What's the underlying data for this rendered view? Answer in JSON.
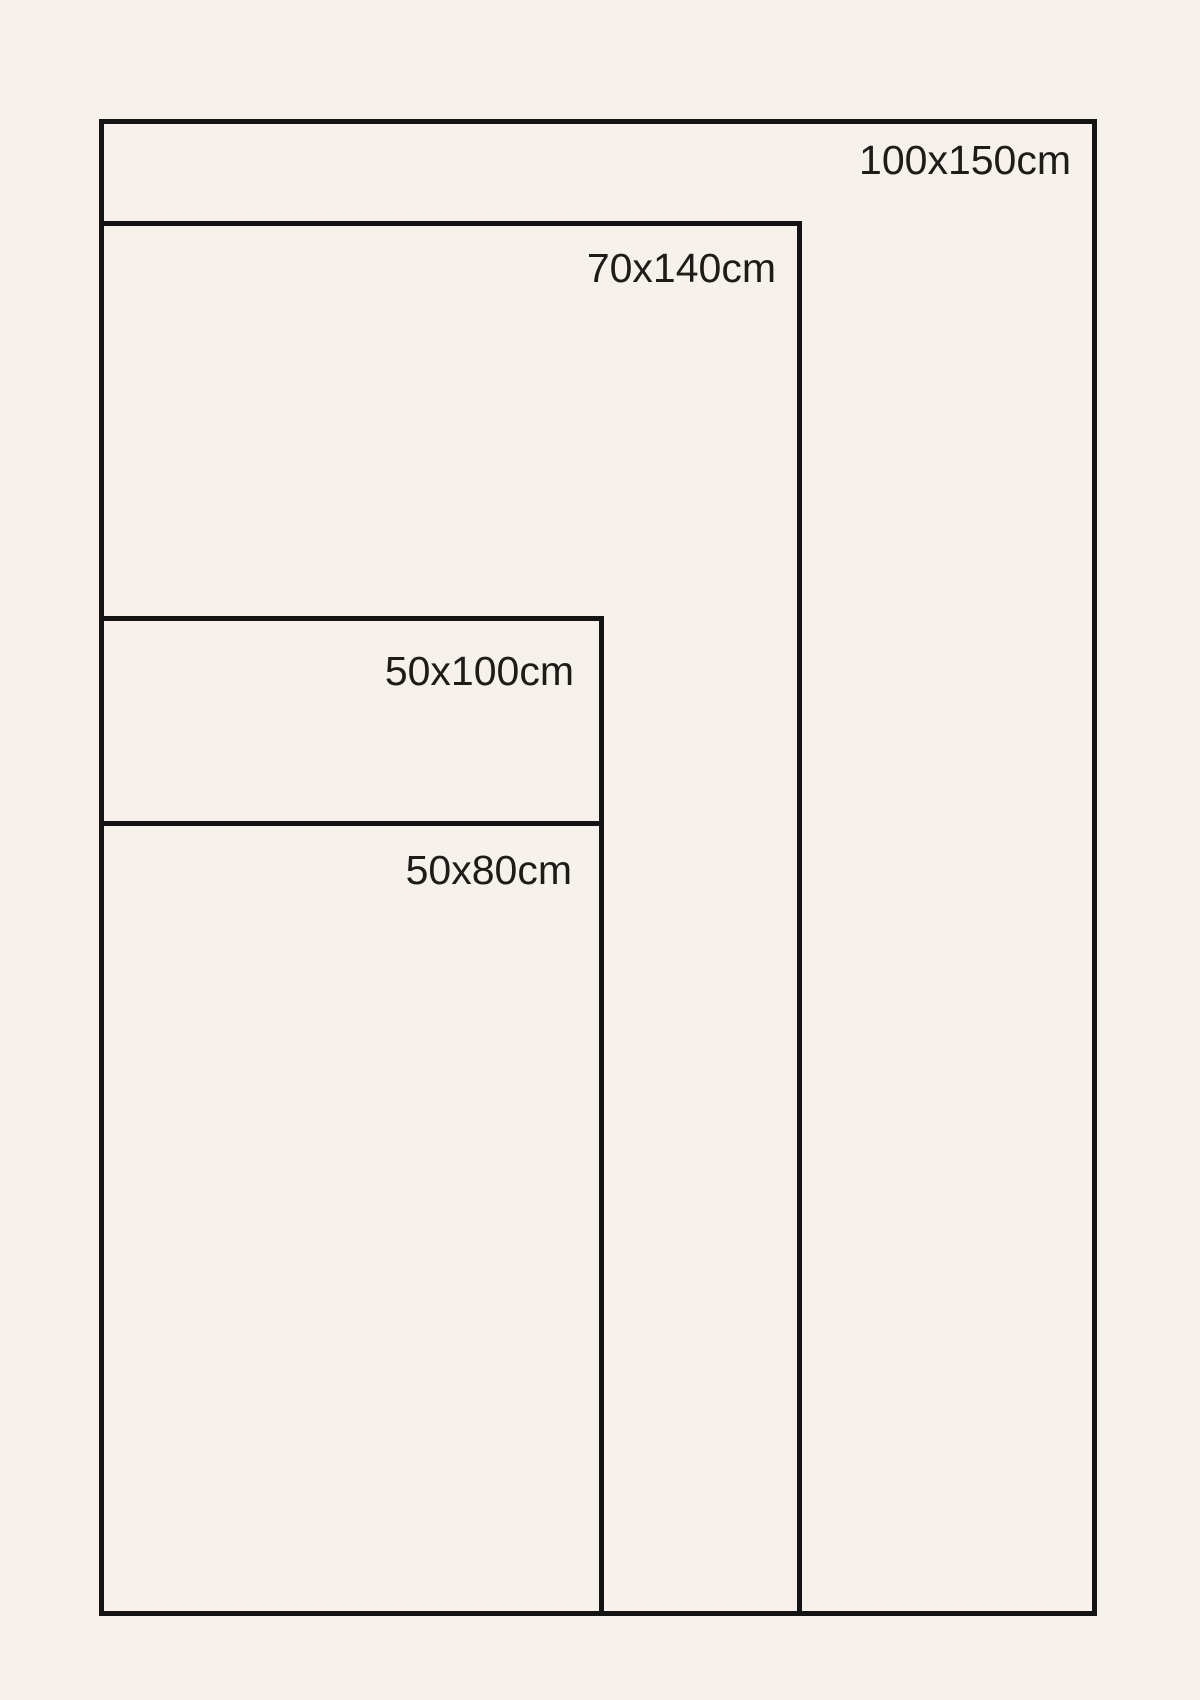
{
  "diagram": {
    "kind": "poster-size-comparison",
    "sizes": [
      {
        "label": "100x150cm",
        "width_cm": 100,
        "height_cm": 150
      },
      {
        "label": "70x140cm",
        "width_cm": 70,
        "height_cm": 140
      },
      {
        "label": "50x100cm",
        "width_cm": 50,
        "height_cm": 100
      },
      {
        "label": "50x80cm",
        "width_cm": 50,
        "height_cm": 80
      }
    ]
  },
  "colors": {
    "background": "#F6F1EB",
    "line": "#141414",
    "text": "#1E1C19"
  }
}
